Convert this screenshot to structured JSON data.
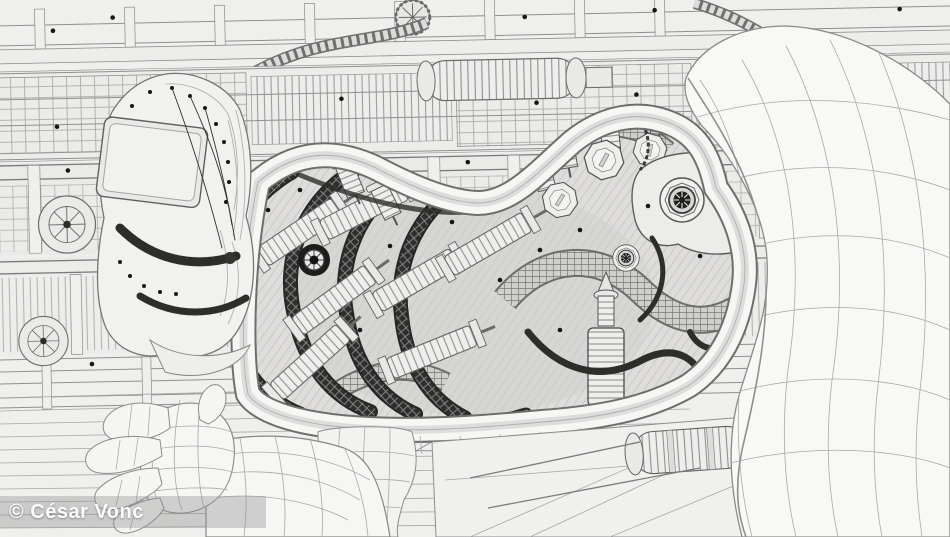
{
  "credit": {
    "text": "© César Vonc"
  },
  "artwork": {
    "style": "monochrome wireframe 3D render",
    "subject": "reclining android figure with exposed mechanical interior, raised knee, open hand and industrial machinery background"
  },
  "colors": {
    "background": "#efefee",
    "line_light": "#ababaa",
    "line_mid": "#7a7a79",
    "line_dark": "#2b2b2b",
    "surface_white": "#f7f7f6",
    "interior_gray": "#dedddc",
    "watermark_bg": "rgba(145,145,145,0.38)",
    "watermark_text": "#fcfcfc"
  }
}
